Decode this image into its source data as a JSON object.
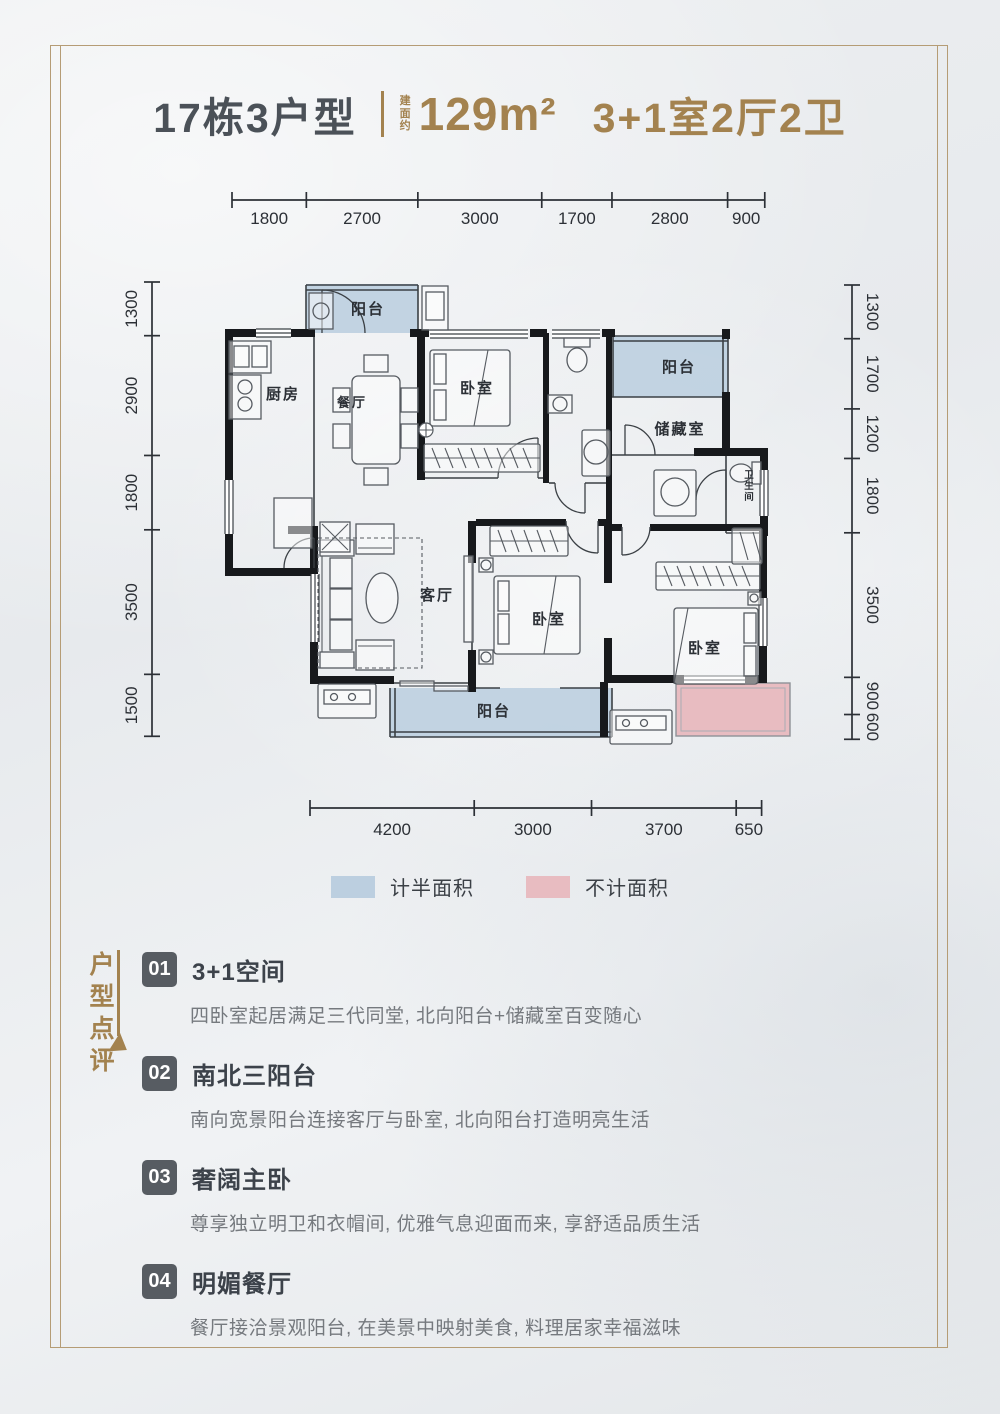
{
  "header": {
    "building": "17栋3户型",
    "area_note": "建面约",
    "area": "129m²",
    "layout": "3+1室2厅2卫"
  },
  "plan": {
    "rooms": {
      "balcony_n": "阳台",
      "kitchen": "厨房",
      "dining": "餐厅",
      "bedroom_n": "卧室",
      "balcony_ne": "阳台",
      "storage": "储藏室",
      "bath_e": "卫生间",
      "living": "客厅",
      "bedroom_s": "卧室",
      "bedroom_m": "卧室",
      "balcony_s": "阳台"
    },
    "dimensions": {
      "top": [
        "1800",
        "2700",
        "3000",
        "1700",
        "2800",
        "900"
      ],
      "bottom": [
        "4200",
        "3000",
        "3700",
        "650"
      ],
      "left": [
        "1300",
        "2900",
        "1800",
        "3500",
        "1500"
      ],
      "right": [
        "1300",
        "1700",
        "1200",
        "1800",
        "3500",
        "900",
        "600"
      ]
    },
    "legend": [
      {
        "label": "计半面积",
        "color": "#bccfe0"
      },
      {
        "label": "不计面积",
        "color": "#e8bcc1"
      }
    ]
  },
  "review": {
    "header": "户型点评",
    "items": [
      {
        "num": "01",
        "title": "3+1空间",
        "desc": "四卧室起居满足三代同堂, 北向阳台+储藏室百变随心"
      },
      {
        "num": "02",
        "title": "南北三阳台",
        "desc": "南向宽景阳台连接客厅与卧室, 北向阳台打造明亮生活"
      },
      {
        "num": "03",
        "title": "奢阔主卧",
        "desc": "尊享独立明卫和衣帽间, 优雅气息迎面而来, 享舒适品质生活"
      },
      {
        "num": "04",
        "title": "明媚餐厅",
        "desc": "餐厅接洽景观阳台, 在美景中映射美食, 料理居家幸福滋味"
      }
    ]
  },
  "colors": {
    "gold": "#a3824f",
    "frame": "#b59c75",
    "title_dark": "#4b5158",
    "wall": "#17191c",
    "half_area_blue": "#bccfe0",
    "excluded_pink": "#e8bcc1",
    "badge_bg": "#575c62"
  }
}
